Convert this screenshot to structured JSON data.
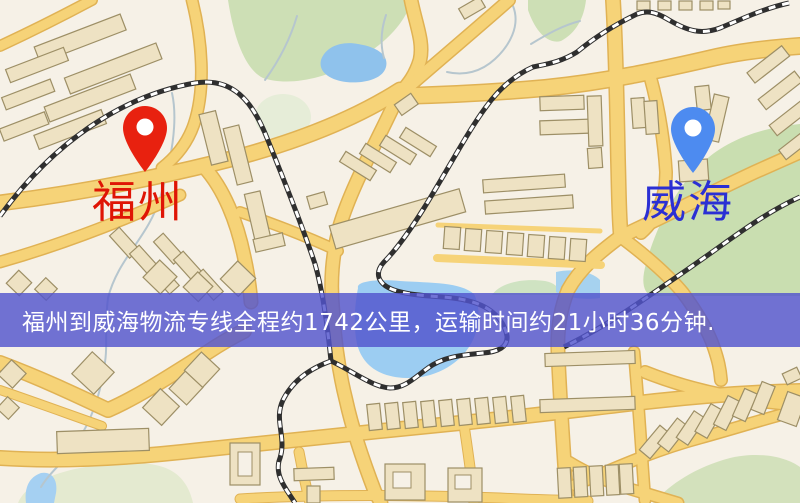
{
  "banner": {
    "text": "福州到威海物流专线全程约1742公里，运输时间约21小时36分钟."
  },
  "markers": {
    "origin": {
      "label": "福州",
      "pin_color": "#e8210f",
      "label_color": "#df1505"
    },
    "destination": {
      "label": "威海",
      "pin_color": "#4d8bf0",
      "label_color": "#2b2fd4"
    }
  },
  "colors": {
    "background": "#f6f1e7",
    "banner_background": "rgba(82,84,205,0.82)",
    "banner_text": "#ffffff",
    "road_fill": "#f6d378",
    "road_casing": "#e0b254",
    "building_fill": "#eee2c3",
    "building_stroke": "#9d8f66",
    "green_area": "#cddfb5",
    "water": "#9ccdf2",
    "railway": "#2f2f2f"
  }
}
